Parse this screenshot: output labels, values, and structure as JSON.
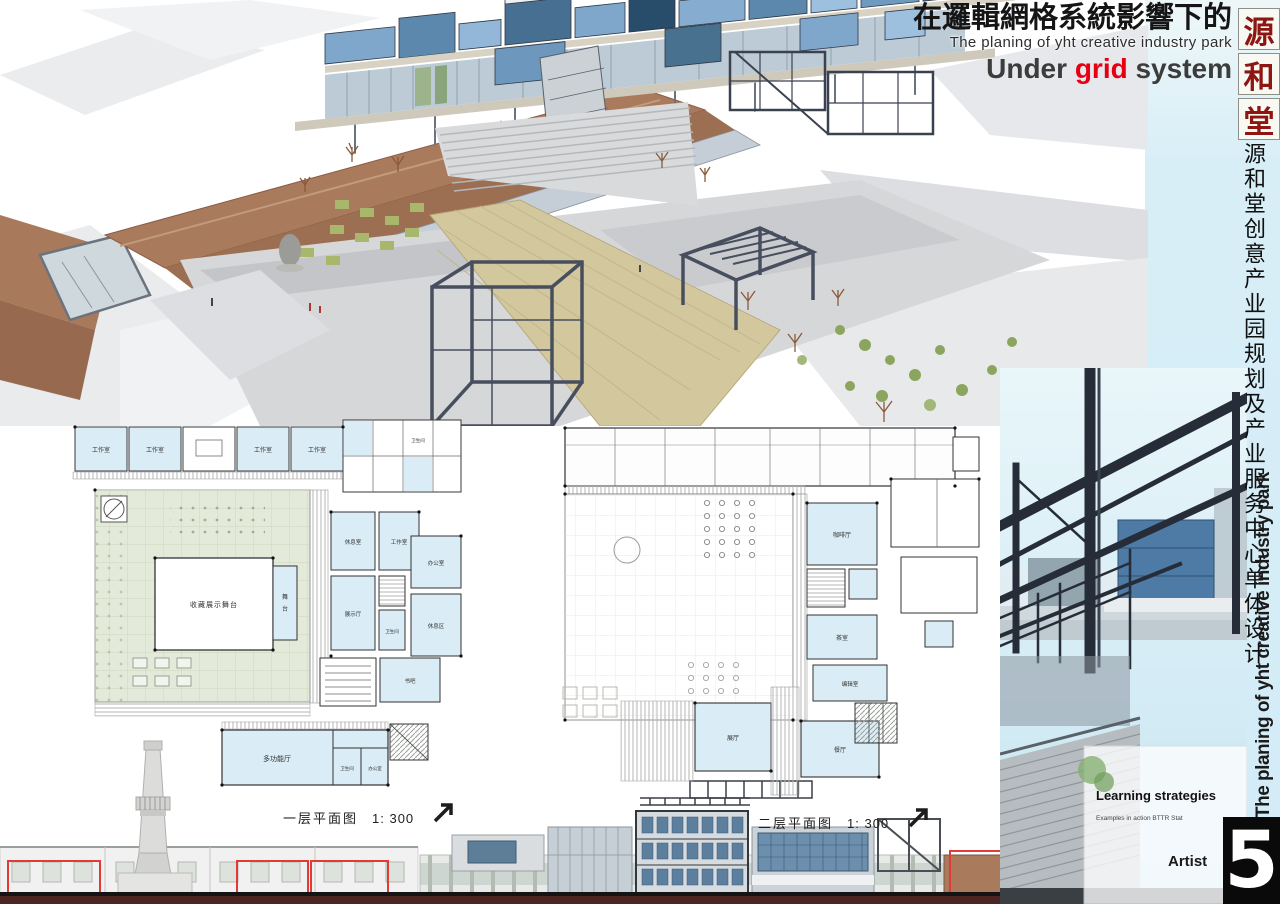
{
  "header": {
    "title_cn": "在邏輯網格系統影響下的",
    "subtitle_en": "The planing of yht creative industry park",
    "tagline": {
      "prefix": "Under ",
      "accent": "grid",
      "suffix": " system"
    }
  },
  "seal": {
    "chars": [
      "源",
      "和",
      "堂"
    ]
  },
  "side": {
    "vertical_cn": "源和堂创意产业园规划及产业服务中心单体设计",
    "vertical_en": "The planing of yht creative industry park"
  },
  "photo_overlay": {
    "heading": "Learning strategies",
    "subtext": "Examples in action  BTTR Stat",
    "caption": "Artist"
  },
  "plans": [
    {
      "label": "一层平面图",
      "scale": "1: 300",
      "rooms": {
        "studios": [
          "工作室",
          "工作室",
          "工作室",
          "工作室"
        ],
        "stage_hall": "收藏展示舞台",
        "stage_a": "舞",
        "stage_b": "台",
        "lounge": "休息室",
        "studio_r": "工作室",
        "exhibition": "展示厅",
        "office": "办公室",
        "rest": "休息区",
        "wc_small": "卫生间",
        "book_bar": "书吧",
        "multi_hall": "多功能厅",
        "wc": "卫生间",
        "office2": "办公室"
      }
    },
    {
      "label": "二层平面图",
      "scale": "1: 300",
      "rooms": {
        "cafe": "咖啡厅",
        "tea": "茶室",
        "editing": "编辑室",
        "gallery": "展厅",
        "restaurant": "餐厅"
      }
    }
  ],
  "page_number": "5",
  "colors": {
    "accent_red": "#e60012",
    "seal_red": "#8e1612",
    "sky": "#d8eef7",
    "plan_room_blue": "#daecf5",
    "plan_green": "#e4ead9",
    "roof_brown": "#aa7a5c",
    "steel_dark": "#3a4250",
    "red_outline": "#e23b35"
  }
}
